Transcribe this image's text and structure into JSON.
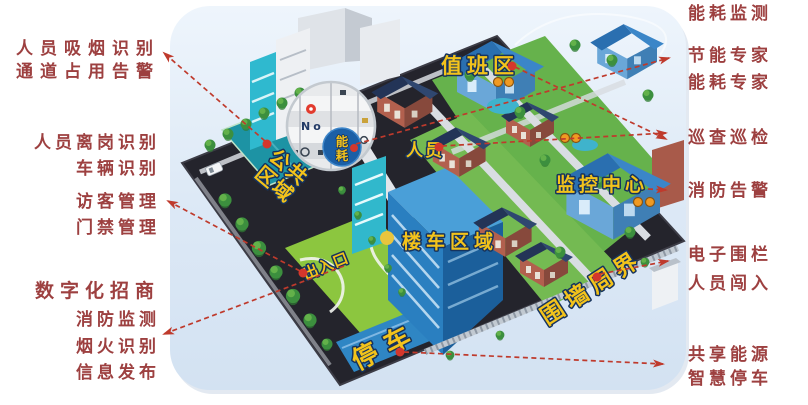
{
  "left_labels": [
    "人员吸烟识别",
    "通道占用告警",
    "人员离岗识别",
    "车辆识别",
    "访客管理",
    "门禁管理",
    "数字化招商",
    "消防监测",
    "烟火识别",
    "信息发布"
  ],
  "right_labels": [
    "能耗监测",
    "节能专家",
    "能耗专家",
    "巡查巡检",
    "消防告警",
    "电子围栏",
    "人员闯入",
    "共享能源",
    "智慧停车"
  ],
  "map_labels": {
    "duty_area": "值班区",
    "personnel": "人员",
    "energy_line1": "能",
    "energy_line2": "耗",
    "public_area_line1": "公共",
    "public_area_line2": "区域",
    "monitoring_center": "监控中心",
    "tower_vehicle_area": "楼车区域",
    "entrance_exit": "出入口",
    "perimeter_wall": "围墙周界",
    "parking": "停车",
    "magnifier_text": "No"
  },
  "colors": {
    "side_label_red": "#9d4040",
    "dashed_line_red": "#bf3a2c",
    "map_label_yellow": "#f3c31b",
    "map_label_outline": "#16335e",
    "panel_light_blue": "#dce9f6",
    "base_dark": "#24242c",
    "lawn_green": "#8cc63f",
    "court_teal": "#1d93a4",
    "building_blue": "#2a7fc0",
    "roof_navy": "#243659",
    "brick_red": "#b2604e",
    "camera_orange": "#f09a22",
    "marker_red": "#d4372c",
    "marker_yellow": "#e9c53d"
  }
}
